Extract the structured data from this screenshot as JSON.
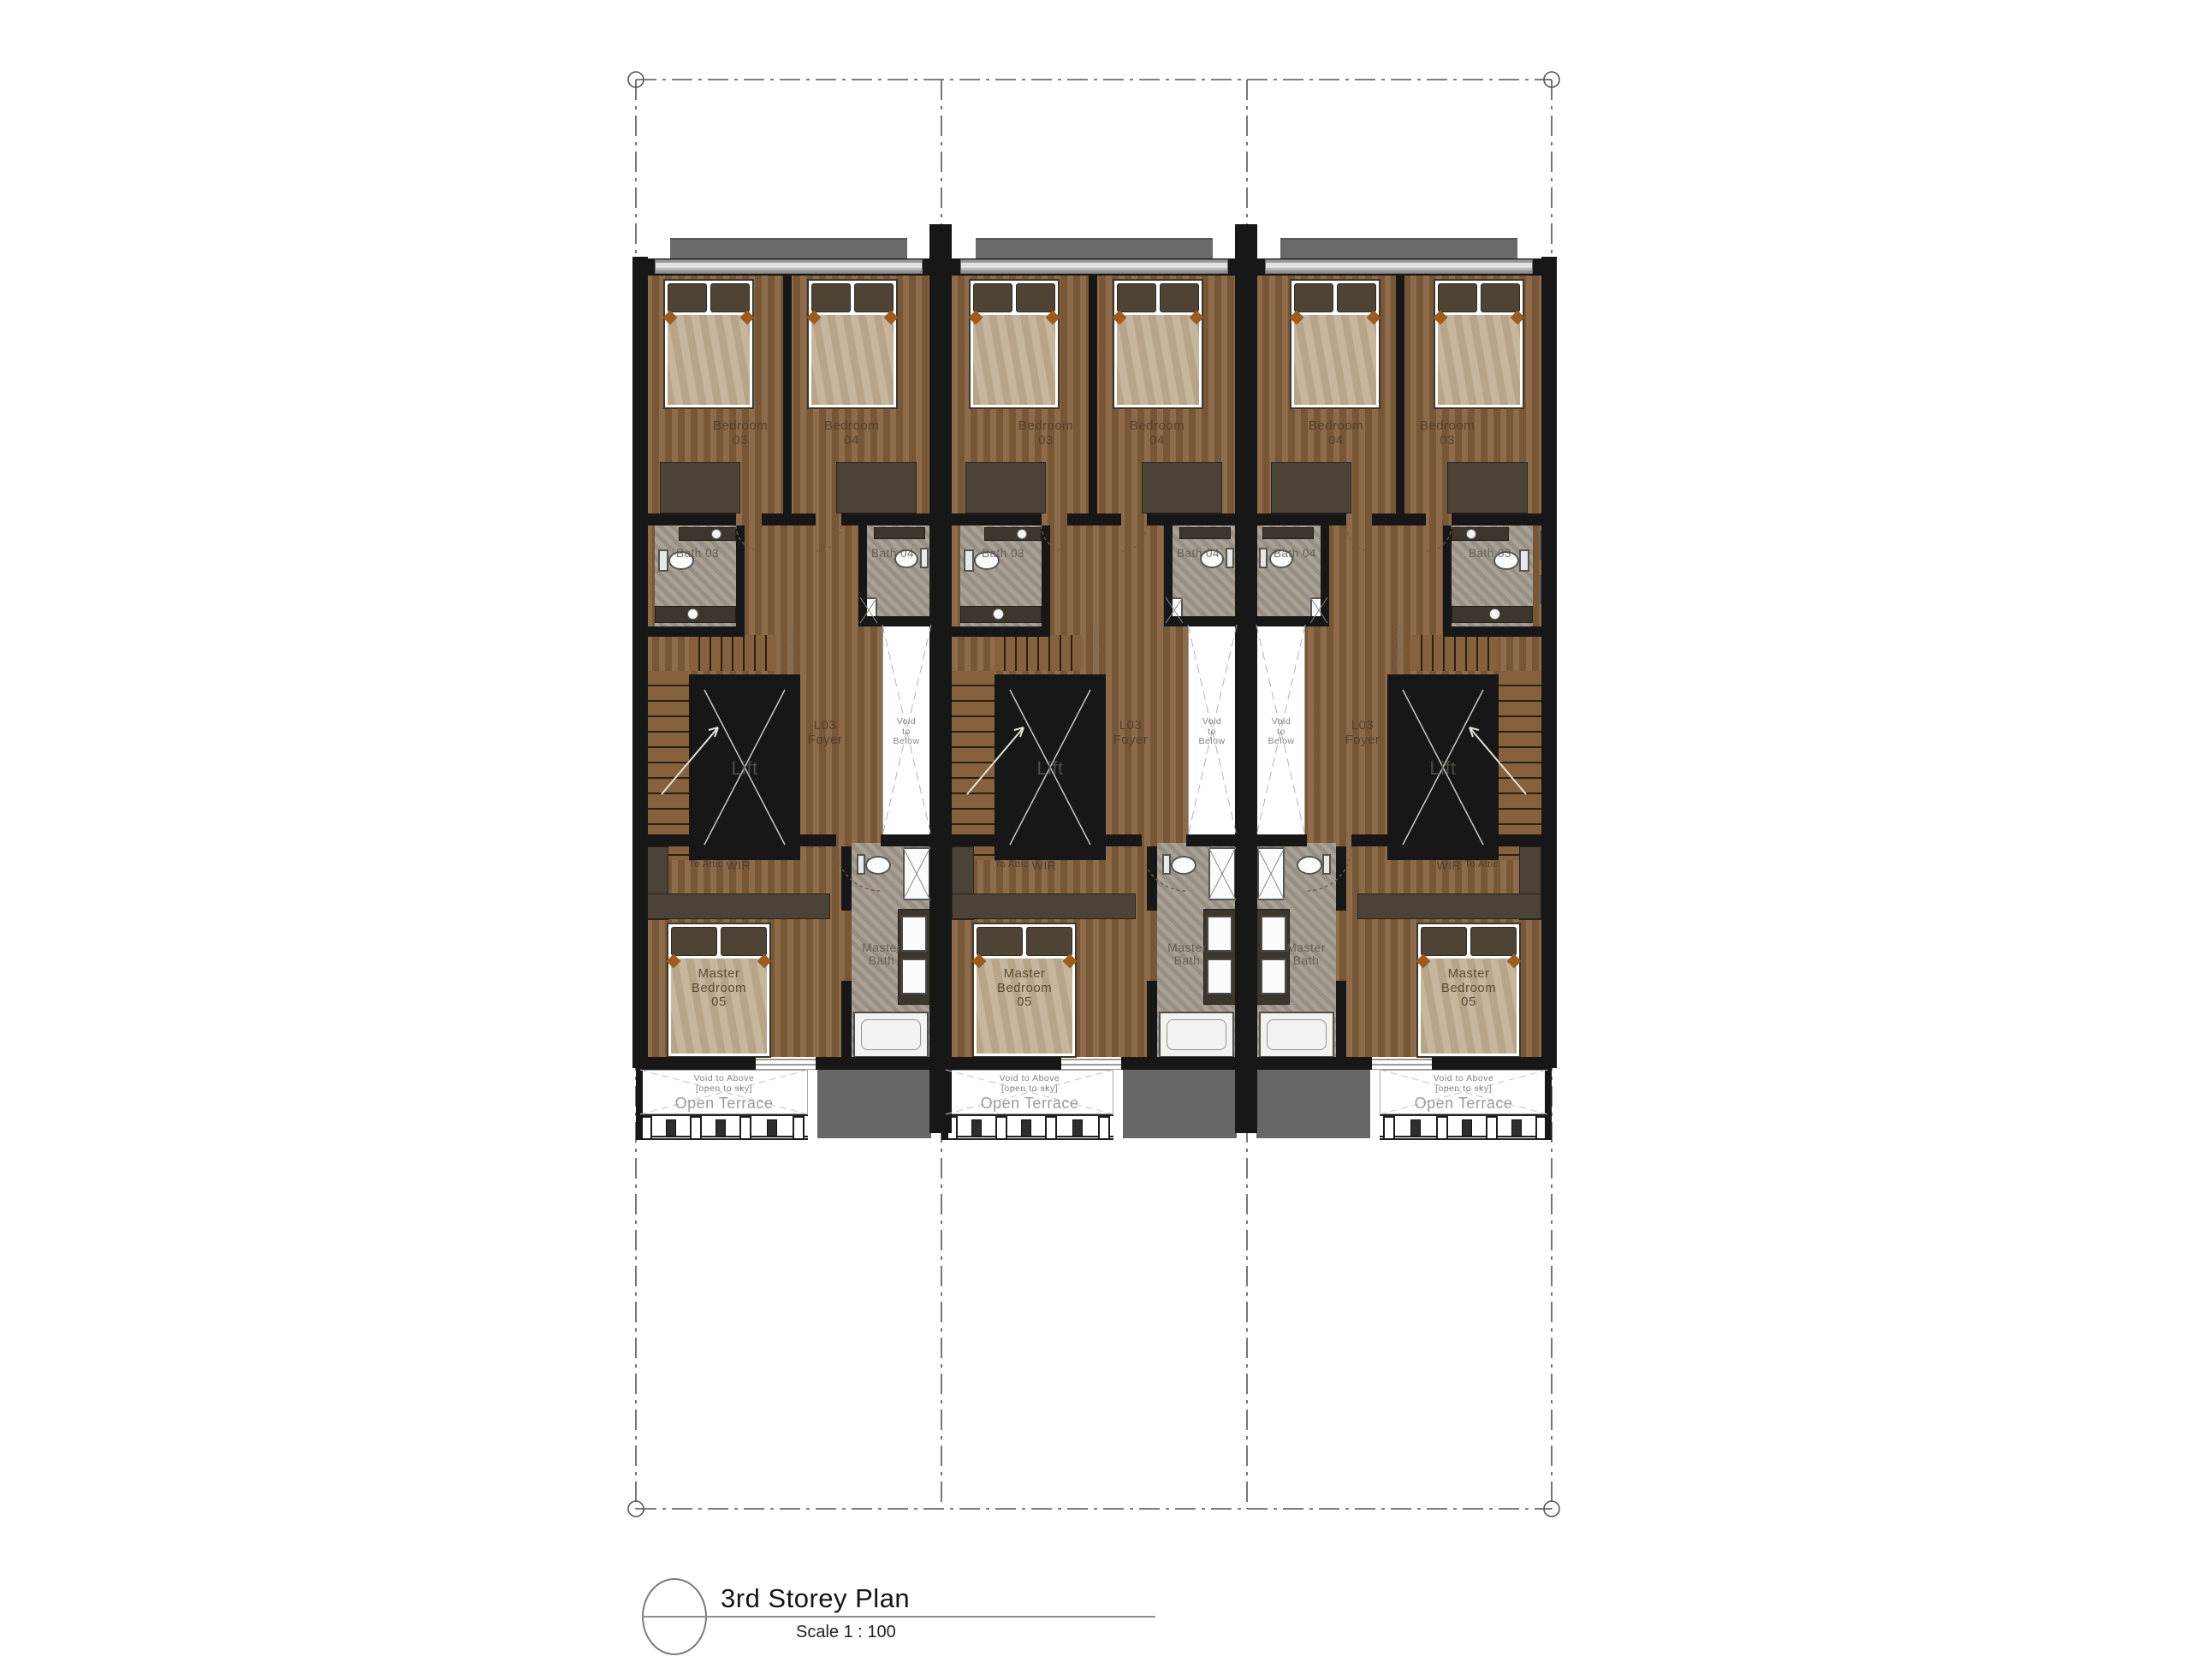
{
  "drawing": {
    "title": "3rd Storey Plan",
    "scale": "Scale 1 : 100",
    "units": [
      {
        "name": "Unit 1",
        "mirrored": false,
        "labels": {
          "bedroom_03": [
            "Bedroom",
            "03"
          ],
          "bedroom_04": [
            "Bedroom",
            "04"
          ],
          "bath_03": "Bath 03",
          "bath_04": "Bath 04",
          "lift": "Lift",
          "foyer": [
            "L03",
            "Foyer"
          ],
          "void_below": [
            "Void",
            "to",
            "Below"
          ],
          "wir": "WIR",
          "master_bath": [
            "Master",
            "Bath"
          ],
          "master_bedroom": [
            "Master",
            "Bedroom",
            "05"
          ],
          "to_attic": "To Attic",
          "from_below": "From Below",
          "terrace_note_1": "Void to Above",
          "terrace_note_2": "[open to sky]",
          "open_terrace": "Open Terrace"
        }
      },
      {
        "name": "Unit 2",
        "mirrored": false,
        "labels": {
          "bedroom_03": [
            "Bedroom",
            "03"
          ],
          "bedroom_04": [
            "Bedroom",
            "04"
          ],
          "bath_03": "Bath 03",
          "bath_04": "Bath 04",
          "lift": "Lift",
          "foyer": [
            "L03",
            "Foyer"
          ],
          "void_below": [
            "Void",
            "to",
            "Below"
          ],
          "wir": "WIR",
          "master_bath": [
            "Master",
            "Bath"
          ],
          "master_bedroom": [
            "Master",
            "Bedroom",
            "05"
          ],
          "to_attic": "To Attic",
          "from_below": "From Below",
          "terrace_note_1": "Void to Above",
          "terrace_note_2": "[open to sky]",
          "open_terrace": "Open Terrace"
        }
      },
      {
        "name": "Unit 3",
        "mirrored": true,
        "labels": {
          "bedroom_03": [
            "Bedroom",
            "03"
          ],
          "bedroom_04": [
            "Bedroom",
            "04"
          ],
          "bath_03": "Bath 03",
          "bath_04": "Bath 04",
          "lift": "Lift",
          "foyer": [
            "L03",
            "Foyer"
          ],
          "void_below": [
            "Void",
            "to",
            "Below"
          ],
          "wir": "WIR",
          "master_bath": [
            "Master",
            "Bath"
          ],
          "master_bedroom": [
            "Master",
            "Bedroom",
            "05"
          ],
          "to_attic": "To Attic",
          "from_below": "From Below",
          "terrace_note_1": "Void to Above",
          "terrace_note_2": "[open to sky]",
          "open_terrace": "Open Terrace"
        }
      }
    ],
    "colors": {
      "wall": "#171717",
      "wood_floor": "#85613d",
      "bath_tile": "#a29a8e",
      "roof_slab": "#676767",
      "awning": "#6a6a6a"
    }
  }
}
